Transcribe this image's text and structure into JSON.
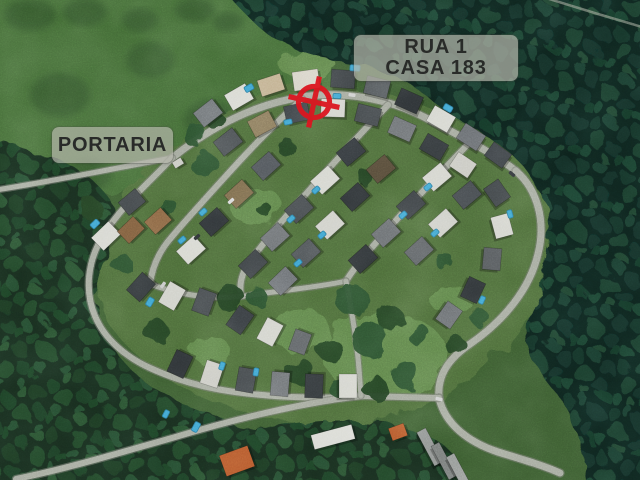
{
  "annotations": {
    "portaria_label": {
      "text": "PORTARIA"
    },
    "house_label": {
      "line1": "RUA 1",
      "line2": "CASA 183"
    },
    "marker": {
      "name": "target-crosshair",
      "cx": 314,
      "cy": 102,
      "ring_r": 15.5,
      "spoke_r": 26,
      "rotation_deg": 12,
      "color": "#dc1620",
      "stroke_w": 5.2
    }
  },
  "palette": {
    "meadow_base": "#3a5a2f",
    "meadow_bright": "#446d37",
    "blotch": "#2b4a26",
    "estate": "#4b6a39",
    "lawn": "#5e8448",
    "road": "#a2a79b",
    "road_casing": "#70746a",
    "tree_a": "#223f21",
    "tree_b": "#2c4f2e",
    "pool": "#3da2cf",
    "pool_edge": "#26769c",
    "shadow": "rgba(0,0,0,0.28)",
    "house_edge": "rgba(0,0,0,0.32)"
  },
  "map_features": {
    "meadow_bright": [
      140,
      78,
      195,
      115
    ],
    "meadow_blotches": [
      [
        60,
        95,
        30,
        22
      ],
      [
        150,
        60,
        24,
        18
      ],
      [
        210,
        120,
        26,
        20
      ],
      [
        90,
        175,
        22,
        16
      ],
      [
        30,
        15,
        26,
        16
      ],
      [
        85,
        12,
        22,
        14
      ],
      [
        140,
        20,
        18,
        12
      ],
      [
        195,
        10,
        20,
        12
      ],
      [
        228,
        22,
        15,
        10
      ]
    ],
    "estate_ground": "M 300,85 C 380,80 468,114 524,164 C 560,198 562,250 540,294 C 516,344 470,386 428,406 C 392,423 330,430 278,420 C 218,409 150,380 114,330 C 88,293 92,240 122,198 C 152,158 222,90 300,85 Z",
    "lawns": [
      [
        255,
        205,
        26,
        20
      ],
      [
        385,
        355,
        62,
        42
      ],
      [
        300,
        330,
        30,
        22
      ],
      [
        308,
        66,
        28,
        14
      ],
      [
        452,
        300,
        22,
        15
      ],
      [
        210,
        350,
        20,
        14
      ]
    ],
    "forests": [
      {
        "d": "M 222,-12 L 652,-12 L 652,492 L 588,492 C 582,438 566,402 544,378 C 527,357 521,330 533,303 C 547,271 553,236 545,206 C 537,177 514,152 484,134 C 452,115 432,100 416,88 C 398,74 364,63 334,60 C 306,57 276,42 258,26 C 248,17 232,0 222,-12 Z",
        "base": "#0f231c",
        "pattern": "canopyA"
      },
      {
        "d": "M -12,142 C 30,146 68,160 94,182 C 116,200 120,228 107,254 C 96,276 90,305 102,330 C 115,358 140,382 172,398 C 204,414 240,424 268,436 C 290,445 300,462 302,492 L -12,492 Z",
        "base": "#152c1d",
        "pattern": "canopyB"
      },
      {
        "d": "M 180,492 C 200,452 240,432 290,424 C 340,416 392,420 428,436 C 452,447 464,464 466,492 Z",
        "base": "#152c1d",
        "pattern": "canopyB"
      }
    ],
    "roads": [
      {
        "d": "M -4,190 C 60,180 115,168 172,158",
        "w": 5
      },
      {
        "d": "M 172,158 C 212,126 256,104 302,97 C 346,90 392,100 426,118 C 456,134 492,152 516,171",
        "w": 7
      },
      {
        "d": "M 516,171 C 538,190 546,222 538,254 C 530,288 505,320 470,344 C 448,359 437,376 439,398",
        "w": 7
      },
      {
        "d": "M 439,398 C 445,424 468,442 498,452 C 521,459 545,466 560,473",
        "w": 7
      },
      {
        "d": "M 172,158 C 150,182 121,206 103,236 C 88,260 84,290 95,316 C 104,338 124,356 150,368 C 176,380 205,388 235,392 C 280,398 330,399 361,396",
        "w": 6
      },
      {
        "d": "M 16,479 C 70,468 122,452 172,438 C 232,420 300,403 361,396 L 439,398",
        "w": 6
      },
      {
        "d": "M 302,99 C 280,119 250,149 225,177 C 205,199 185,221 170,239 C 159,252 152,268 150,284",
        "w": 6
      },
      {
        "d": "M 388,105 C 360,134 330,167 305,195 C 285,217 265,241 250,261 C 242,272 239,284 241,296",
        "w": 6
      },
      {
        "d": "M 472,140 C 445,168 415,199 390,227 C 372,247 356,265 346,281",
        "w": 6
      },
      {
        "d": "M 150,284 C 185,297 220,300 252,295 C 292,289 320,287 346,281",
        "w": 5
      },
      {
        "d": "M 346,281 C 352,312 357,342 359,369 L 361,396",
        "w": 5
      },
      {
        "d": "M 546,-2 L 598,14 L 642,27",
        "w": 2.5,
        "faint": true
      }
    ],
    "tree_blobs": [
      [
        203,
        163,
        13
      ],
      [
        287,
        148,
        9
      ],
      [
        168,
        210,
        11
      ],
      [
        230,
        298,
        14
      ],
      [
        352,
        300,
        16
      ],
      [
        390,
        318,
        13
      ],
      [
        418,
        334,
        11
      ],
      [
        300,
        372,
        14
      ],
      [
        338,
        386,
        11
      ],
      [
        375,
        388,
        12
      ],
      [
        405,
        374,
        14
      ],
      [
        455,
        345,
        10
      ],
      [
        480,
        318,
        9
      ],
      [
        366,
        178,
        8
      ],
      [
        445,
        262,
        9
      ],
      [
        265,
        210,
        7
      ],
      [
        370,
        340,
        18
      ],
      [
        330,
        350,
        12
      ],
      [
        256,
        296,
        10
      ],
      [
        155,
        330,
        12
      ],
      [
        120,
        262,
        10
      ],
      [
        92,
        210,
        11
      ],
      [
        195,
        135,
        12
      ],
      [
        215,
        120,
        9
      ]
    ],
    "houses": [
      [
        208,
        113,
        24,
        18,
        -38,
        "#6e7376"
      ],
      [
        239,
        97,
        24,
        18,
        -30,
        "#d8d9d2"
      ],
      [
        271,
        85,
        24,
        17,
        -18,
        "#c2b191"
      ],
      [
        306,
        80,
        26,
        19,
        -8,
        "#d6d2c6"
      ],
      [
        343,
        79,
        24,
        18,
        4,
        "#3a3f42"
      ],
      [
        377,
        87,
        24,
        18,
        14,
        "#54595c"
      ],
      [
        409,
        101,
        24,
        18,
        24,
        "#2e3336"
      ],
      [
        441,
        119,
        24,
        18,
        30,
        "#d5d6cf"
      ],
      [
        471,
        137,
        24,
        18,
        33,
        "#6a6e72"
      ],
      [
        498,
        155,
        22,
        17,
        36,
        "#3c4145"
      ],
      [
        228,
        142,
        24,
        18,
        -38,
        "#4a4f52"
      ],
      [
        262,
        124,
        24,
        18,
        -28,
        "#8a7a5c"
      ],
      [
        297,
        113,
        24,
        18,
        -12,
        "#3d4246"
      ],
      [
        333,
        108,
        24,
        18,
        2,
        "#d2d3cc"
      ],
      [
        368,
        115,
        24,
        18,
        14,
        "#474c4f"
      ],
      [
        402,
        129,
        24,
        18,
        24,
        "#6d7174"
      ],
      [
        434,
        147,
        24,
        18,
        30,
        "#33383b"
      ],
      [
        463,
        165,
        22,
        17,
        34,
        "#c9c9c2"
      ],
      [
        266,
        166,
        24,
        18,
        -42,
        "#50555a"
      ],
      [
        239,
        194,
        24,
        18,
        -42,
        "#7b6a4c"
      ],
      [
        214,
        222,
        24,
        18,
        -42,
        "#2f3437"
      ],
      [
        191,
        250,
        24,
        18,
        -42,
        "#d6d7d0"
      ],
      [
        132,
        202,
        22,
        17,
        -40,
        "#3f4447"
      ],
      [
        106,
        236,
        24,
        18,
        -44,
        "#d5d6cf"
      ],
      [
        131,
        230,
        22,
        17,
        -44,
        "#7b5a3a"
      ],
      [
        158,
        221,
        22,
        17,
        -42,
        "#8a6644"
      ],
      [
        141,
        287,
        24,
        18,
        -48,
        "#33383b"
      ],
      [
        172,
        296,
        24,
        18,
        -60,
        "#d0d1ca"
      ],
      [
        204,
        302,
        24,
        18,
        -70,
        "#454a4d"
      ],
      [
        351,
        152,
        24,
        18,
        -40,
        "#33383c"
      ],
      [
        325,
        180,
        24,
        18,
        -42,
        "#d4d5ce"
      ],
      [
        299,
        209,
        24,
        18,
        -42,
        "#454a4d"
      ],
      [
        275,
        237,
        24,
        18,
        -42,
        "#6c7073"
      ],
      [
        253,
        264,
        24,
        18,
        -44,
        "#3d4245"
      ],
      [
        381,
        169,
        24,
        18,
        -40,
        "#564b39"
      ],
      [
        355,
        197,
        24,
        18,
        -42,
        "#2e3336"
      ],
      [
        330,
        225,
        24,
        18,
        -42,
        "#cfd0c9"
      ],
      [
        306,
        253,
        24,
        18,
        -42,
        "#4f5457"
      ],
      [
        283,
        281,
        24,
        18,
        -44,
        "#6e7276"
      ],
      [
        437,
        177,
        24,
        18,
        -40,
        "#d2d3cc"
      ],
      [
        411,
        205,
        24,
        18,
        -42,
        "#3b4043"
      ],
      [
        386,
        233,
        24,
        18,
        -42,
        "#696d70"
      ],
      [
        363,
        259,
        24,
        18,
        -42,
        "#2f3437"
      ],
      [
        467,
        195,
        24,
        18,
        -40,
        "#474c50"
      ],
      [
        443,
        223,
        24,
        18,
        -42,
        "#cdcec7"
      ],
      [
        419,
        251,
        24,
        18,
        -42,
        "#5d6164"
      ],
      [
        497,
        193,
        22,
        18,
        55,
        "#3f4447"
      ],
      [
        502,
        226,
        22,
        18,
        75,
        "#d3d4cd"
      ],
      [
        492,
        259,
        22,
        18,
        95,
        "#54585b"
      ],
      [
        473,
        290,
        22,
        18,
        115,
        "#2f3437"
      ],
      [
        449,
        315,
        22,
        18,
        125,
        "#6b6f72"
      ],
      [
        240,
        320,
        24,
        18,
        -55,
        "#3a3f43"
      ],
      [
        270,
        332,
        24,
        18,
        -62,
        "#d1d2cb"
      ],
      [
        300,
        342,
        22,
        17,
        -70,
        "#5f6366"
      ],
      [
        180,
        364,
        24,
        18,
        -65,
        "#2f3437"
      ],
      [
        212,
        374,
        24,
        18,
        -72,
        "#c9c9c2"
      ],
      [
        246,
        380,
        24,
        18,
        -80,
        "#44494c"
      ],
      [
        280,
        384,
        24,
        18,
        -85,
        "#6d7174"
      ],
      [
        314,
        386,
        24,
        18,
        -88,
        "#33383b"
      ],
      [
        348,
        386,
        24,
        18,
        90,
        "#d3d4cd"
      ],
      [
        178,
        163,
        10,
        7,
        -32,
        "#c9cac3"
      ],
      [
        333,
        437,
        42,
        15,
        -15,
        "#d9dad4"
      ],
      [
        398,
        432,
        16,
        13,
        -20,
        "#b4572b"
      ],
      [
        237,
        461,
        30,
        22,
        -20,
        "#b4572b"
      ],
      [
        430,
        447,
        38,
        10,
        62,
        "#8f9391"
      ],
      [
        444,
        461,
        38,
        9,
        62,
        "#7a7e7c"
      ],
      [
        459,
        472,
        38,
        9,
        62,
        "#989c99"
      ]
    ],
    "pools": [
      [
        249,
        88,
        9,
        6,
        -30
      ],
      [
        355,
        68,
        10,
        6,
        4
      ],
      [
        448,
        108,
        9,
        6,
        30
      ],
      [
        288,
        122,
        8,
        5,
        -12
      ],
      [
        337,
        96,
        8,
        5,
        2
      ],
      [
        203,
        212,
        8,
        5,
        -42
      ],
      [
        182,
        240,
        8,
        5,
        -42
      ],
      [
        316,
        190,
        8,
        5,
        -42
      ],
      [
        291,
        219,
        8,
        5,
        -42
      ],
      [
        322,
        235,
        8,
        5,
        -42
      ],
      [
        298,
        263,
        8,
        5,
        -42
      ],
      [
        428,
        187,
        8,
        5,
        -40
      ],
      [
        403,
        215,
        8,
        5,
        -42
      ],
      [
        435,
        233,
        8,
        5,
        -42
      ],
      [
        510,
        214,
        8,
        5,
        75
      ],
      [
        482,
        300,
        8,
        5,
        115
      ],
      [
        95,
        224,
        9,
        6,
        -44
      ],
      [
        150,
        302,
        9,
        6,
        -60
      ],
      [
        222,
        366,
        8,
        5,
        -72
      ],
      [
        256,
        372,
        8,
        5,
        -80
      ],
      [
        196,
        427,
        10,
        6,
        -62
      ],
      [
        166,
        414,
        8,
        5,
        -62
      ]
    ],
    "cars": [
      [
        231,
        201,
        -42,
        "#d9d9d9"
      ],
      [
        197,
        237,
        -42,
        "#2b2f33"
      ],
      [
        352,
        95,
        8,
        "#d0d0d0"
      ],
      [
        439,
        399,
        15,
        "#cfcfcf"
      ],
      [
        163,
        285,
        -55,
        "#c8c8c8"
      ],
      [
        512,
        174,
        40,
        "#2f3337"
      ]
    ]
  }
}
